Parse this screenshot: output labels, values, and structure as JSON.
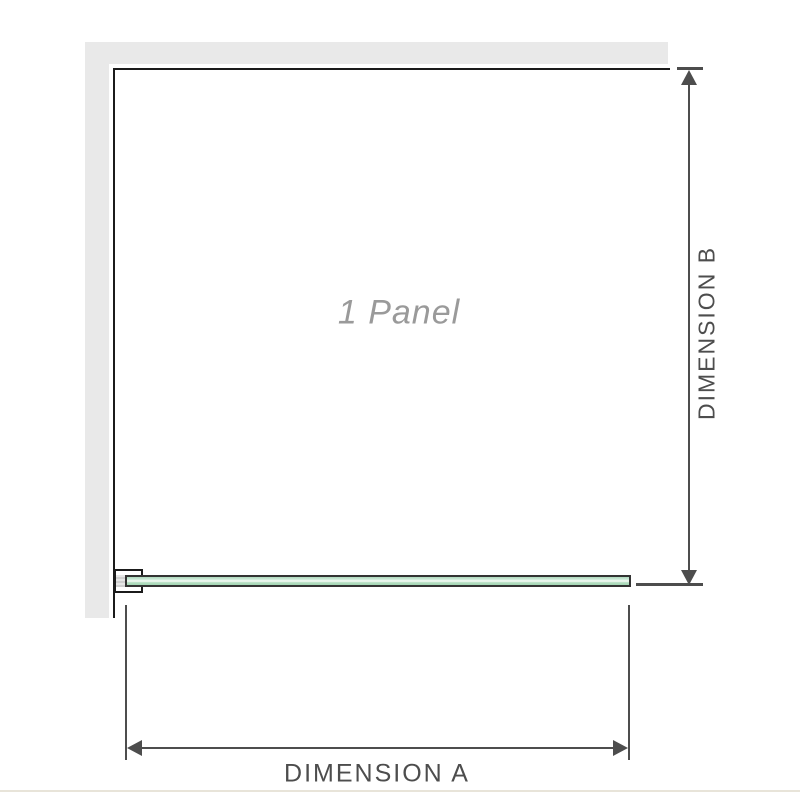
{
  "diagram": {
    "panel_label": "1 Panel",
    "dimensions": {
      "a_label": "DIMENSION A",
      "b_label": "DIMENSION B"
    }
  },
  "icons": {
    "arrow_up": "dimension-arrow-up-icon",
    "arrow_down": "dimension-arrow-down-icon",
    "arrow_left": "dimension-arrow-left-icon",
    "arrow_right": "dimension-arrow-right-icon"
  },
  "colors": {
    "wall_fill": "#e9e9e9",
    "edge_line": "#1b1b1b",
    "dimension_line": "#4d4d4d",
    "dimension_text": "#4d4d4d",
    "panel_label_text": "#9a9a9a",
    "glass_border": "#333333",
    "glass_green": "#abdcbc",
    "glass_green_light": "#eef8f0",
    "footer_divider": "#e8e4d9"
  }
}
